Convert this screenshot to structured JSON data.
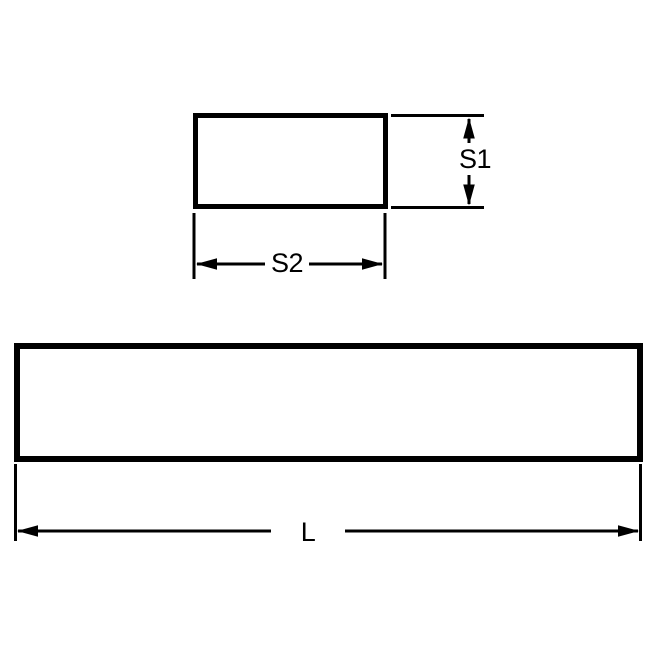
{
  "diagram": {
    "colors": {
      "line": "#000000",
      "text": "#000000",
      "bg": "#ffffff"
    },
    "labels": {
      "s1": "S1",
      "s2": "S2",
      "length": "L"
    }
  }
}
